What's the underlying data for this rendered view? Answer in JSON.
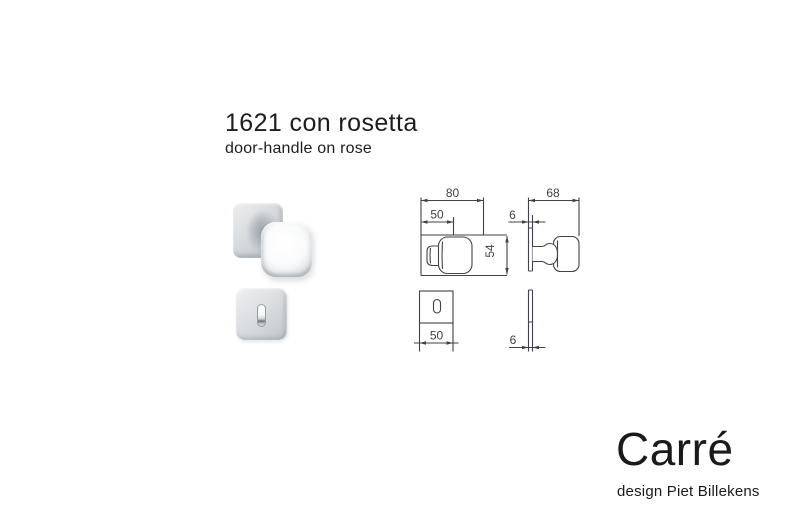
{
  "page": {
    "title": "1621 con rosetta",
    "subtitle": "door-handle on rose"
  },
  "brand": {
    "name": "Carré",
    "designer": "design Piet Billekens"
  },
  "drawings": {
    "knob_front": {
      "overall_width": "80",
      "rose_width": "50",
      "height": "54"
    },
    "knob_side": {
      "depth": "68",
      "rose_thickness": "6"
    },
    "keyrose_front": {
      "width": "50"
    },
    "keyrose_side": {
      "thickness": "6"
    }
  },
  "colors": {
    "background": "#ffffff",
    "text": "#1d1d1b",
    "drawing_line": "#3f4246",
    "metal_light": "#f5f7f8",
    "metal_mid": "#cdd2d6",
    "metal_dark": "#9aa1a7"
  }
}
